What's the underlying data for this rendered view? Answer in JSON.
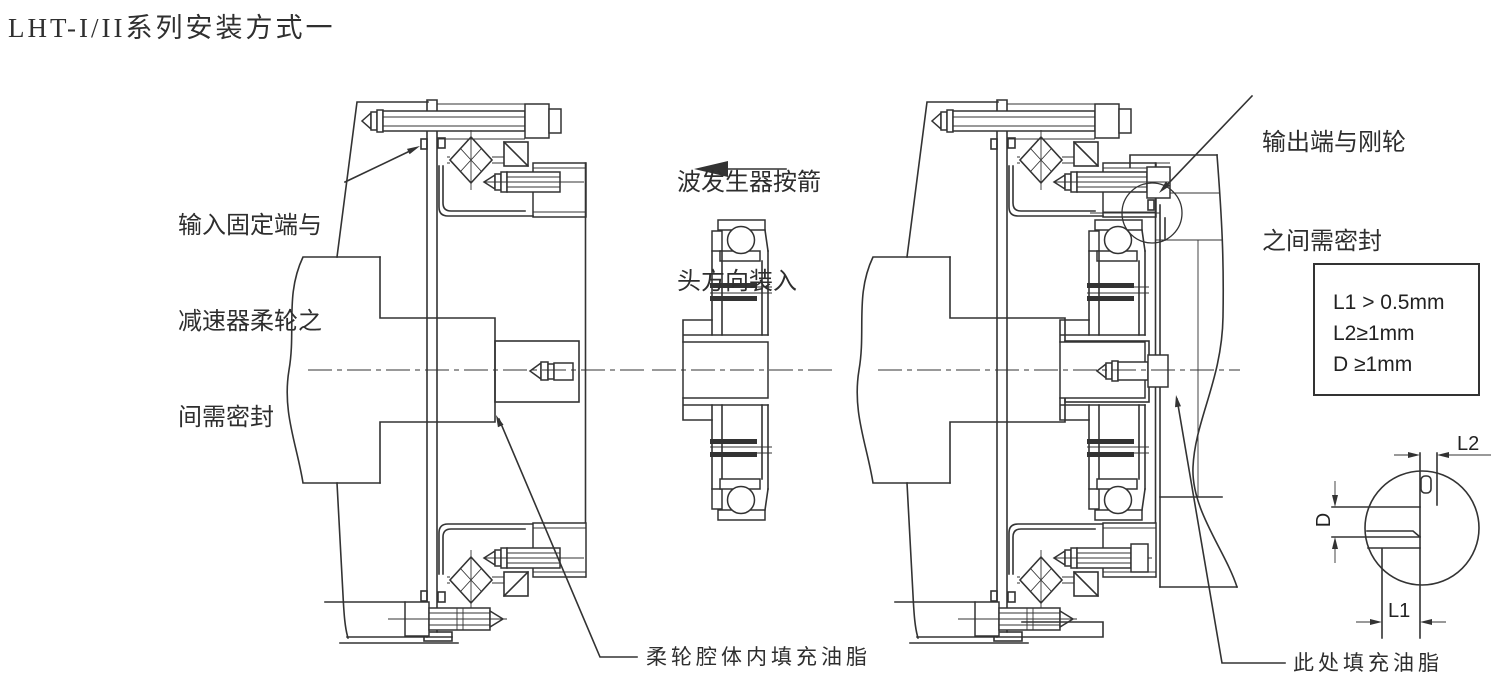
{
  "page": {
    "title": "LHT-I/II系列安装方式一"
  },
  "annotations": {
    "input_seal": {
      "line1": "输入固定端与",
      "line2": "减速器柔轮之",
      "line3": "间需密封"
    },
    "wave_generator": {
      "line1": "波发生器按箭",
      "line2": "头方向装入"
    },
    "output_seal": {
      "line1": "输出端与刚轮",
      "line2": "之间需密封"
    },
    "flexspline_grease": "柔轮腔体内填充油脂",
    "grease_here": "此处填充油脂"
  },
  "spec_box": {
    "line1": "L1 > 0.5mm",
    "line2": "L2≥1mm",
    "line3": "D ≥1mm"
  },
  "detail_view": {
    "dim_l1": "L1",
    "dim_l2": "L2",
    "dim_d": "D"
  },
  "drawing": {
    "line_color": "#333333",
    "background": "#ffffff"
  }
}
